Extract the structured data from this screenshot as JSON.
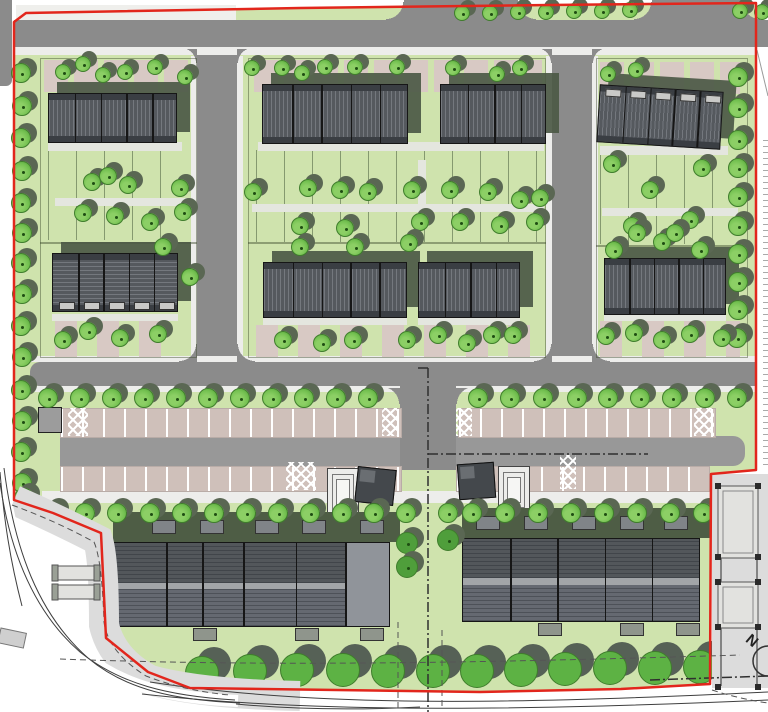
{
  "title": "residential-site-plan",
  "north": {
    "label": "N"
  },
  "colors": {
    "site": "#cfe3ad",
    "road": "#8b8b8b",
    "aisle": "#989898",
    "sidewalk": "#ededeb",
    "paleStrip": "#efefec",
    "parkBase": "#cfc0ba",
    "footway": "#d8d8d4",
    "roofDark": "#55595e",
    "roofEdge": "#3a3e43",
    "roofLine": "#74787e",
    "outline": "#161616",
    "aptRoofA": "#53575b",
    "aptRoofB": "#656971",
    "aptLight": "#90949a",
    "aptGap": "#a2a5a8",
    "shadow": "#4c5945",
    "olive": "#4e5d45",
    "red": "#e2261c",
    "treeFill": "#74c151",
    "treeHi": "#8ccf65",
    "treeLo": "#4e9a36",
    "treeEdge": "#3f7d2c",
    "treeShadow": "#5a6753",
    "bigTree": "#5db244",
    "bigShadow": "#566156",
    "darkTree": "#4f9e3b",
    "hatchBg": "#e4e6df",
    "hatchLine": "#979d92",
    "padBg": "#8f958c",
    "padLine": "#3c423a",
    "pink": "#d8c9c4",
    "grayOut": "#dcdcdc",
    "sub": "#9c9c9c",
    "line": "#3f3f3f",
    "structFill": "#e2e2df",
    "structEdge": "#555555",
    "post": "#2b2b2b",
    "white": "#ffffff"
  },
  "base": {
    "left_road_strip": [
      0,
      0,
      12,
      86
    ],
    "left_gap": [
      12,
      0,
      3,
      86
    ],
    "pale_top_strip": [
      16,
      5,
      220,
      15
    ],
    "tick_strip": [
      763,
      140,
      5,
      330
    ]
  },
  "roads": {
    "top": [
      14,
      20,
      754,
      27
    ],
    "stubs": [
      [
        404,
        0,
        114,
        20
      ],
      [
        652,
        0,
        90,
        20
      ]
    ],
    "v1": [
      197,
      47,
      40,
      321
    ],
    "v2": [
      552,
      47,
      40,
      321
    ],
    "mid": [
      30,
      362,
      727,
      24
    ],
    "connector": [
      400,
      386,
      56,
      84
    ],
    "fillets": [
      [
        386,
        2,
        18,
        18,
        "tl"
      ],
      [
        518,
        2,
        18,
        18,
        "tr"
      ],
      [
        634,
        2,
        18,
        18,
        "tl"
      ],
      [
        742,
        2,
        18,
        18,
        "tr"
      ],
      [
        181,
        49,
        16,
        14,
        "bl"
      ],
      [
        237,
        49,
        16,
        14,
        "br"
      ],
      [
        536,
        49,
        16,
        14,
        "bl"
      ],
      [
        592,
        49,
        16,
        14,
        "br"
      ],
      [
        179,
        344,
        18,
        18,
        "tl"
      ],
      [
        237,
        344,
        18,
        18,
        "tr"
      ],
      [
        534,
        344,
        18,
        18,
        "tl"
      ],
      [
        592,
        344,
        18,
        18,
        "tr"
      ],
      [
        382,
        388,
        18,
        16,
        "bl"
      ],
      [
        456,
        388,
        18,
        16,
        "br"
      ]
    ]
  },
  "sidewalks": [
    [
      14,
      47,
      743,
      8
    ],
    [
      191,
      56,
      6,
      306
    ],
    [
      237,
      56,
      6,
      306
    ],
    [
      546,
      56,
      6,
      306
    ],
    [
      592,
      56,
      6,
      306
    ],
    [
      30,
      356,
      727,
      6
    ],
    [
      30,
      386,
      727,
      6
    ],
    [
      42,
      491,
      670,
      12
    ]
  ],
  "parking": {
    "stripe_period": 21,
    "rows": [
      [
        60,
        408,
        340,
        28
      ],
      [
        60,
        466,
        340,
        24
      ],
      [
        458,
        408,
        256,
        28
      ],
      [
        456,
        466,
        252,
        24
      ]
    ],
    "aisles": [
      [
        60,
        436,
        340,
        30
      ],
      [
        456,
        436,
        289,
        30
      ]
    ],
    "xhatch": [
      [
        68,
        408,
        20,
        28
      ],
      [
        382,
        408,
        17,
        28
      ],
      [
        456,
        408,
        16,
        28
      ],
      [
        694,
        408,
        20,
        28
      ],
      [
        286,
        462,
        30,
        28
      ],
      [
        560,
        455,
        16,
        34
      ]
    ],
    "substation": [
      38,
      407,
      22,
      24
    ]
  },
  "gardens": {
    "plots": [
      [
        40,
        58,
        155,
        184
      ],
      [
        40,
        242,
        155,
        114
      ],
      [
        248,
        58,
        296,
        184
      ],
      [
        248,
        242,
        296,
        114
      ],
      [
        596,
        58,
        150,
        187
      ],
      [
        596,
        245,
        150,
        111
      ]
    ],
    "plot_lines": [
      [
        48,
        150,
        140,
        90
      ],
      [
        256,
        150,
        290,
        92
      ],
      [
        600,
        152,
        140,
        92
      ]
    ],
    "patio_bands": [
      [
        44,
        60,
        148,
        32
      ],
      [
        254,
        60,
        288,
        32
      ],
      [
        600,
        62,
        140,
        32
      ]
    ],
    "walk_hatch": [
      [
        48,
        142,
        134,
        9
      ],
      [
        258,
        142,
        286,
        9
      ],
      [
        600,
        146,
        128,
        9
      ]
    ],
    "garden_paths": [
      [
        55,
        198,
        138,
        8
      ],
      [
        252,
        204,
        292,
        8
      ],
      [
        602,
        208,
        136,
        8
      ],
      [
        418,
        160,
        8,
        46
      ]
    ],
    "front_hatch": [
      [
        52,
        314,
        126,
        7
      ],
      [
        263,
        318,
        144,
        7
      ],
      [
        418,
        318,
        102,
        7
      ],
      [
        604,
        314,
        122,
        7
      ]
    ],
    "drive_bands": [
      [
        55,
        321,
        125,
        36
      ],
      [
        256,
        325,
        284,
        32
      ],
      [
        600,
        321,
        140,
        36
      ]
    ]
  },
  "buildings": [
    {
      "id": "terrace-1",
      "x": 48,
      "y": 93,
      "w": 129,
      "h": 50,
      "units": 5,
      "dir": "v"
    },
    {
      "id": "terrace-2",
      "x": 262,
      "y": 84,
      "w": 146,
      "h": 60,
      "units": 5,
      "dir": "v"
    },
    {
      "id": "terrace-3",
      "x": 440,
      "y": 84,
      "w": 106,
      "h": 60,
      "units": 4,
      "dir": "v"
    },
    {
      "id": "terrace-4",
      "x": 598,
      "y": 88,
      "w": 124,
      "h": 58,
      "units": 5,
      "dir": "v",
      "rot": 3.5,
      "windows": "top"
    },
    {
      "id": "terrace-5",
      "x": 52,
      "y": 253,
      "w": 126,
      "h": 59,
      "units": 5,
      "dir": "h",
      "windows": "bottom"
    },
    {
      "id": "terrace-6",
      "x": 263,
      "y": 262,
      "w": 144,
      "h": 56,
      "units": 5,
      "dir": "v"
    },
    {
      "id": "terrace-7",
      "x": 418,
      "y": 262,
      "w": 102,
      "h": 56,
      "units": 4,
      "dir": "v"
    },
    {
      "id": "terrace-8",
      "x": 604,
      "y": 258,
      "w": 122,
      "h": 57,
      "units": 5,
      "dir": "v"
    }
  ],
  "apartments": [
    {
      "id": "apartment-west",
      "x": 113,
      "y": 542,
      "w": 277,
      "h": 85,
      "dividers": [
        0.19,
        0.32,
        0.47,
        0.66,
        0.84
      ],
      "lightEnd": true,
      "pads": [
        [
          193,
          628
        ],
        [
          295,
          628
        ],
        [
          360,
          628
        ]
      ],
      "band": [
        113,
        512,
        287,
        30
      ],
      "tabs": [
        152,
        200,
        255,
        302,
        360
      ]
    },
    {
      "id": "apartment-east",
      "x": 462,
      "y": 538,
      "w": 238,
      "h": 84,
      "dividers": [
        0.2,
        0.4,
        0.6,
        0.8
      ],
      "lightEnd": false,
      "pads": [
        [
          538,
          623
        ],
        [
          620,
          623
        ],
        [
          676,
          623
        ]
      ],
      "band": [
        462,
        508,
        248,
        30
      ],
      "tabs": [
        476,
        524,
        572,
        620,
        664
      ]
    }
  ],
  "center_structures": {
    "concentric": [
      [
        327,
        468,
        30,
        49
      ],
      [
        498,
        466,
        30,
        46
      ]
    ],
    "sheds": [
      [
        356,
        468,
        37,
        34,
        6
      ],
      [
        458,
        463,
        35,
        34,
        -4
      ]
    ]
  },
  "trees": {
    "top_verge": {
      "r": 8,
      "pts": [
        [
          462,
          13
        ],
        [
          490,
          13
        ],
        [
          518,
          12
        ],
        [
          546,
          12
        ],
        [
          574,
          11
        ],
        [
          602,
          11
        ],
        [
          630,
          10
        ],
        [
          740,
          11
        ],
        [
          762,
          12
        ]
      ]
    },
    "left_column": {
      "r": 10,
      "pts": [
        [
          21,
          73
        ],
        [
          22,
          106
        ],
        [
          21,
          138
        ],
        [
          22,
          171
        ],
        [
          21,
          203
        ],
        [
          22,
          233
        ],
        [
          21,
          263
        ],
        [
          22,
          294
        ],
        [
          21,
          326
        ],
        [
          22,
          357
        ],
        [
          21,
          390
        ],
        [
          22,
          421
        ],
        [
          21,
          452
        ],
        [
          22,
          483
        ],
        [
          24,
          498
        ]
      ]
    },
    "right_column": {
      "r": 10,
      "pts": [
        [
          738,
          77
        ],
        [
          738,
          108
        ],
        [
          738,
          140
        ],
        [
          738,
          168
        ],
        [
          738,
          197
        ],
        [
          738,
          226
        ],
        [
          738,
          254
        ],
        [
          738,
          282
        ],
        [
          738,
          310
        ],
        [
          737,
          338
        ]
      ]
    },
    "patio": {
      "r": 8,
      "pts": [
        [
          63,
          72
        ],
        [
          83,
          64
        ],
        [
          103,
          75
        ],
        [
          125,
          72
        ],
        [
          155,
          67
        ],
        [
          185,
          77
        ],
        [
          252,
          68
        ],
        [
          282,
          68
        ],
        [
          302,
          73
        ],
        [
          325,
          67
        ],
        [
          355,
          67
        ],
        [
          397,
          67
        ],
        [
          453,
          68
        ],
        [
          497,
          74
        ],
        [
          520,
          68
        ],
        [
          608,
          74
        ],
        [
          636,
          70
        ]
      ]
    },
    "garden": {
      "r": 9,
      "pts": [
        [
          92,
          182
        ],
        [
          108,
          176
        ],
        [
          128,
          185
        ],
        [
          180,
          188
        ],
        [
          83,
          213
        ],
        [
          115,
          216
        ],
        [
          150,
          222
        ],
        [
          183,
          212
        ],
        [
          253,
          192
        ],
        [
          308,
          188
        ],
        [
          340,
          190
        ],
        [
          368,
          192
        ],
        [
          412,
          190
        ],
        [
          450,
          190
        ],
        [
          488,
          192
        ],
        [
          520,
          200
        ],
        [
          540,
          198
        ],
        [
          420,
          222
        ],
        [
          460,
          222
        ],
        [
          500,
          225
        ],
        [
          535,
          222
        ],
        [
          300,
          226
        ],
        [
          345,
          228
        ],
        [
          612,
          164
        ],
        [
          650,
          190
        ],
        [
          702,
          168
        ],
        [
          632,
          226
        ],
        [
          690,
          220
        ],
        [
          662,
          242
        ],
        [
          637,
          233
        ],
        [
          675,
          233
        ],
        [
          163,
          247
        ],
        [
          190,
          277
        ],
        [
          300,
          247
        ],
        [
          355,
          247
        ],
        [
          409,
          243
        ],
        [
          614,
          250
        ],
        [
          700,
          250
        ]
      ]
    },
    "driveway": {
      "r": 9,
      "pts": [
        [
          63,
          340
        ],
        [
          88,
          331
        ],
        [
          120,
          338
        ],
        [
          158,
          334
        ],
        [
          283,
          340
        ],
        [
          322,
          343
        ],
        [
          353,
          340
        ],
        [
          407,
          340
        ],
        [
          438,
          335
        ],
        [
          467,
          343
        ],
        [
          492,
          335
        ],
        [
          513,
          335
        ],
        [
          606,
          336
        ],
        [
          634,
          333
        ],
        [
          662,
          340
        ],
        [
          690,
          334
        ],
        [
          722,
          338
        ]
      ]
    },
    "verge_top": {
      "r": 10,
      "pts": [
        [
          48,
          398
        ],
        [
          80,
          398
        ],
        [
          112,
          398
        ],
        [
          144,
          398
        ],
        [
          176,
          398
        ],
        [
          208,
          398
        ],
        [
          240,
          398
        ],
        [
          272,
          398
        ],
        [
          304,
          398
        ],
        [
          336,
          398
        ],
        [
          368,
          398
        ],
        [
          478,
          398
        ],
        [
          510,
          398
        ],
        [
          543,
          398
        ],
        [
          577,
          398
        ],
        [
          608,
          398
        ],
        [
          640,
          398
        ],
        [
          672,
          398
        ],
        [
          705,
          398
        ],
        [
          737,
          398
        ]
      ]
    },
    "verge_bottom": {
      "r": 10,
      "pts": [
        [
          53,
          513
        ],
        [
          85,
          513
        ],
        [
          117,
          513
        ],
        [
          150,
          513
        ],
        [
          182,
          513
        ],
        [
          214,
          513
        ],
        [
          246,
          513
        ],
        [
          278,
          513
        ],
        [
          310,
          513
        ],
        [
          342,
          513
        ],
        [
          374,
          513
        ],
        [
          406,
          513
        ],
        [
          448,
          513
        ],
        [
          472,
          513
        ],
        [
          505,
          513
        ],
        [
          538,
          513
        ],
        [
          571,
          513
        ],
        [
          604,
          513
        ],
        [
          637,
          513
        ],
        [
          670,
          513
        ],
        [
          703,
          513
        ],
        [
          734,
          513
        ]
      ]
    },
    "center_dark": {
      "r": 11,
      "dark": true,
      "pts": [
        [
          407,
          543
        ],
        [
          407,
          567
        ],
        [
          448,
          540
        ]
      ]
    },
    "large_front": {
      "r": 17,
      "big": true,
      "pts": [
        [
          202,
          673
        ],
        [
          250,
          671
        ],
        [
          297,
          670
        ],
        [
          343,
          670
        ],
        [
          388,
          671
        ],
        [
          433,
          671
        ],
        [
          477,
          671
        ],
        [
          521,
          670
        ],
        [
          565,
          669
        ],
        [
          610,
          668
        ],
        [
          655,
          668
        ],
        [
          700,
          667
        ]
      ]
    }
  },
  "linework": {
    "boundary_points": "14,500 14,22 26,13 300,8 550,5 756,3 756,470 711,474 710,684 621,689 480,692 190,688 148,672 106,638 101,533 53,513 14,500",
    "pavement_band": "M14,500 Q55,518 98,540 Q104,560 104,625 Q112,660 150,680 Q200,694 300,696",
    "road_white": "M2,476 C12,550 36,613 84,655 C123,687 172,698 238,701",
    "road_lines": [
      "M4,468 C14,548 38,614 88,658 C126,690 175,700 240,703",
      "M0,483 C10,552 34,612 80,652 C120,684 168,696 235,700",
      "M0,472 C4,520 10,560 22,606",
      "M150,682 C320,708 520,704 768,692",
      "M142,694 C320,714 540,710 768,700",
      "M236,704 C300,710 360,710 420,707"
    ],
    "dashdot": [
      "M418,368 L430,368",
      "M428,368 L428,712",
      "M428,454 L648,454",
      "M650,680 L768,676"
    ],
    "dashed": [
      "M60,659 C250,666 450,664 740,655",
      "M398,622 L398,710",
      "M442,630 L442,706",
      "M12,505 Q58,522 94,542 Q102,560 104,622 Q108,652 146,676 Q185,691 230,695",
      "M712,690 Q740,699 768,703"
    ],
    "diag_notch": "M757,50 L768,96",
    "crosswalk": [
      1,
      628,
      26,
      15
    ],
    "shelters": [
      [
        58,
        566,
        36,
        14
      ],
      [
        58,
        585,
        36,
        14
      ]
    ],
    "right_strip": [
      712,
      474,
      56,
      214
    ],
    "right_decks": [
      [
        718,
        486,
        40,
        72
      ],
      [
        718,
        582,
        40,
        46
      ]
    ],
    "rail_x": [
      721,
      757
    ],
    "rail_y1": 628,
    "rail_y2": 686,
    "posts": [
      [
        715,
        483
      ],
      [
        755,
        483
      ],
      [
        715,
        554
      ],
      [
        755,
        554
      ],
      [
        715,
        579
      ],
      [
        755,
        579
      ],
      [
        715,
        624
      ],
      [
        755,
        624
      ],
      [
        715,
        684
      ],
      [
        755,
        684
      ]
    ],
    "north_arc": "M768,646 A15,15 0 0 0 768,676"
  }
}
